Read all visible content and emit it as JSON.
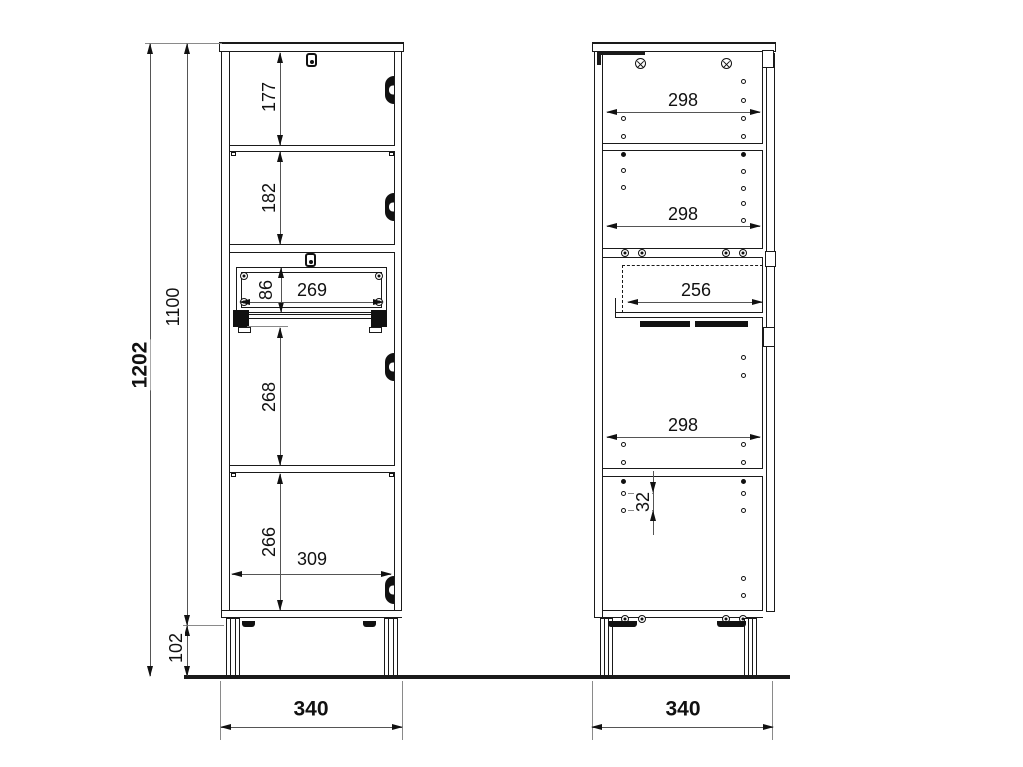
{
  "drawing_type": "cabinet technical drawing, two orthographic views with dimensions (mm)",
  "front_view": {
    "name": "front view",
    "dims": {
      "overall_height": "1202",
      "carcass_height": "1100",
      "leg_height": "102",
      "top_compartment": "177",
      "second_compartment": "182",
      "drawer_opening_height": "86",
      "drawer_back_width": "269",
      "third_compartment": "268",
      "bottom_compartment": "266",
      "interior_width": "309",
      "overall_width": "340"
    }
  },
  "side_view": {
    "name": "side view",
    "dims": {
      "interior_depth_1": "298",
      "interior_depth_2": "298",
      "drawer_depth": "256",
      "interior_depth_3": "298",
      "hole_pitch": "32",
      "overall_depth": "340"
    },
    "drill_holes": {
      "left_column_x": 623,
      "right_column_x": 743,
      "left_open_y": [
        118,
        136,
        170,
        187,
        444,
        462,
        493,
        510
      ],
      "left_filled_y": [
        154,
        481
      ],
      "right_open_y": [
        81,
        100,
        118,
        136,
        171,
        188,
        203,
        220,
        357,
        375,
        444,
        462,
        493,
        510,
        578,
        595
      ],
      "right_filled_y": [
        154,
        481
      ]
    }
  },
  "colors": {
    "line": "#1a1a1a",
    "dim_line": "#555555",
    "background": "#ffffff"
  }
}
